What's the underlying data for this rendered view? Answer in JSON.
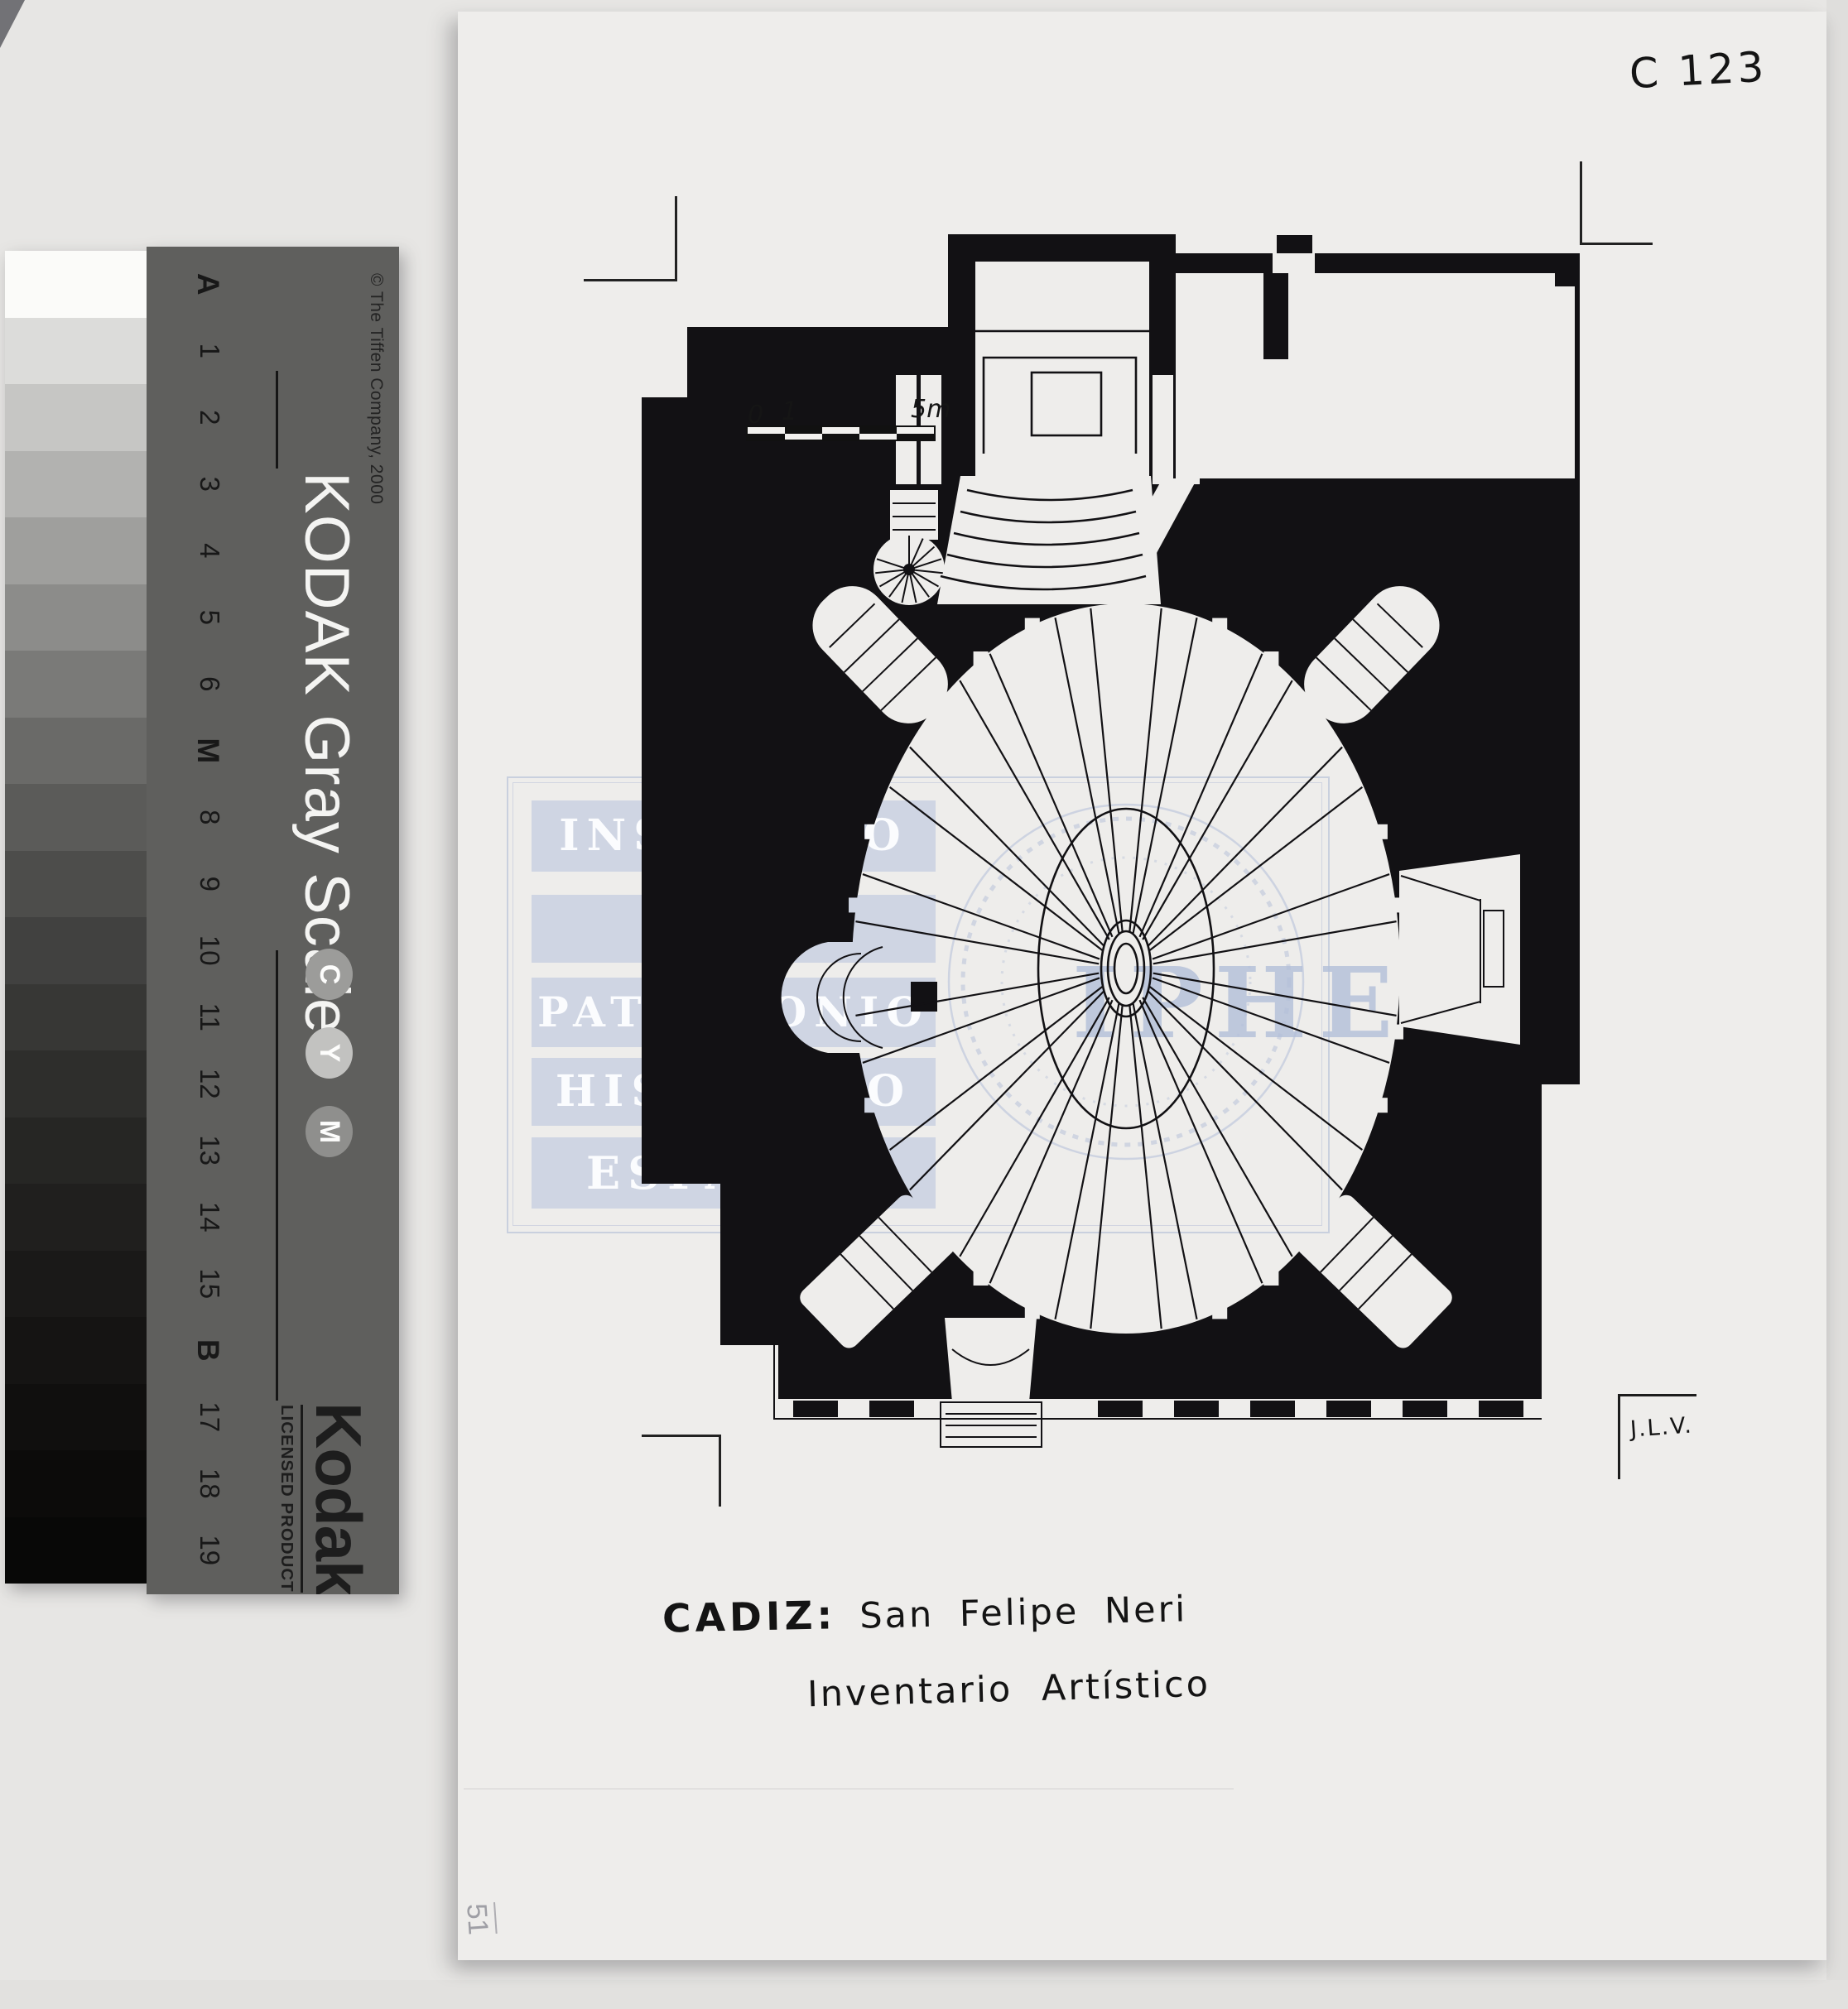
{
  "archive": {
    "reference_code": "C 123",
    "signature": "J.L.V.",
    "pencil_note": "51"
  },
  "caption": {
    "location": "CADIZ:",
    "title": "San Felipe Neri",
    "subtitle": "Inventario Artístico"
  },
  "scale_bar": {
    "labels": [
      "0",
      "1",
      "5m"
    ]
  },
  "watermark": {
    "rows": [
      "INSTITUTO",
      "DEL",
      "PATRIMONIO",
      "HISTÓRICO",
      "ESPAÑOL"
    ],
    "acronym": "IPHE"
  },
  "grayscale_card": {
    "brand_title": "KODAK Gray Scale",
    "copyright": "© The Tiffen Company, 2000",
    "logo": "Kodak",
    "logo_subtitle": "LICENSED PRODUCT",
    "cym_letters": [
      "C",
      "Y",
      "M"
    ],
    "cym_colors": [
      "#9c9c9a",
      "#c2c2c0",
      "#8f8f8d"
    ],
    "step_labels": [
      "A",
      "1",
      "2",
      "3",
      "4",
      "5",
      "6",
      "M",
      "8",
      "9",
      "10",
      "11",
      "12",
      "13",
      "14",
      "15",
      "B",
      "17",
      "18",
      "19"
    ],
    "steps_hex": [
      "#fbfbf9",
      "#dcdcda",
      "#c6c6c4",
      "#b2b2b0",
      "#9f9f9d",
      "#8c8c8a",
      "#7a7a78",
      "#6a6a68",
      "#5b5b59",
      "#4d4d4b",
      "#414140",
      "#373735",
      "#2e2e2c",
      "#262624",
      "#201f1e",
      "#1a1918",
      "#151413",
      "#100f0e",
      "#0c0b0a",
      "#080807"
    ]
  },
  "colors": {
    "ink": "#121114",
    "paper_sheet": "#eeedeb",
    "scanner_bg": "#e7e6e4",
    "card_band": "#5f5f5d",
    "watermark_blue": "#b8c4dd"
  }
}
